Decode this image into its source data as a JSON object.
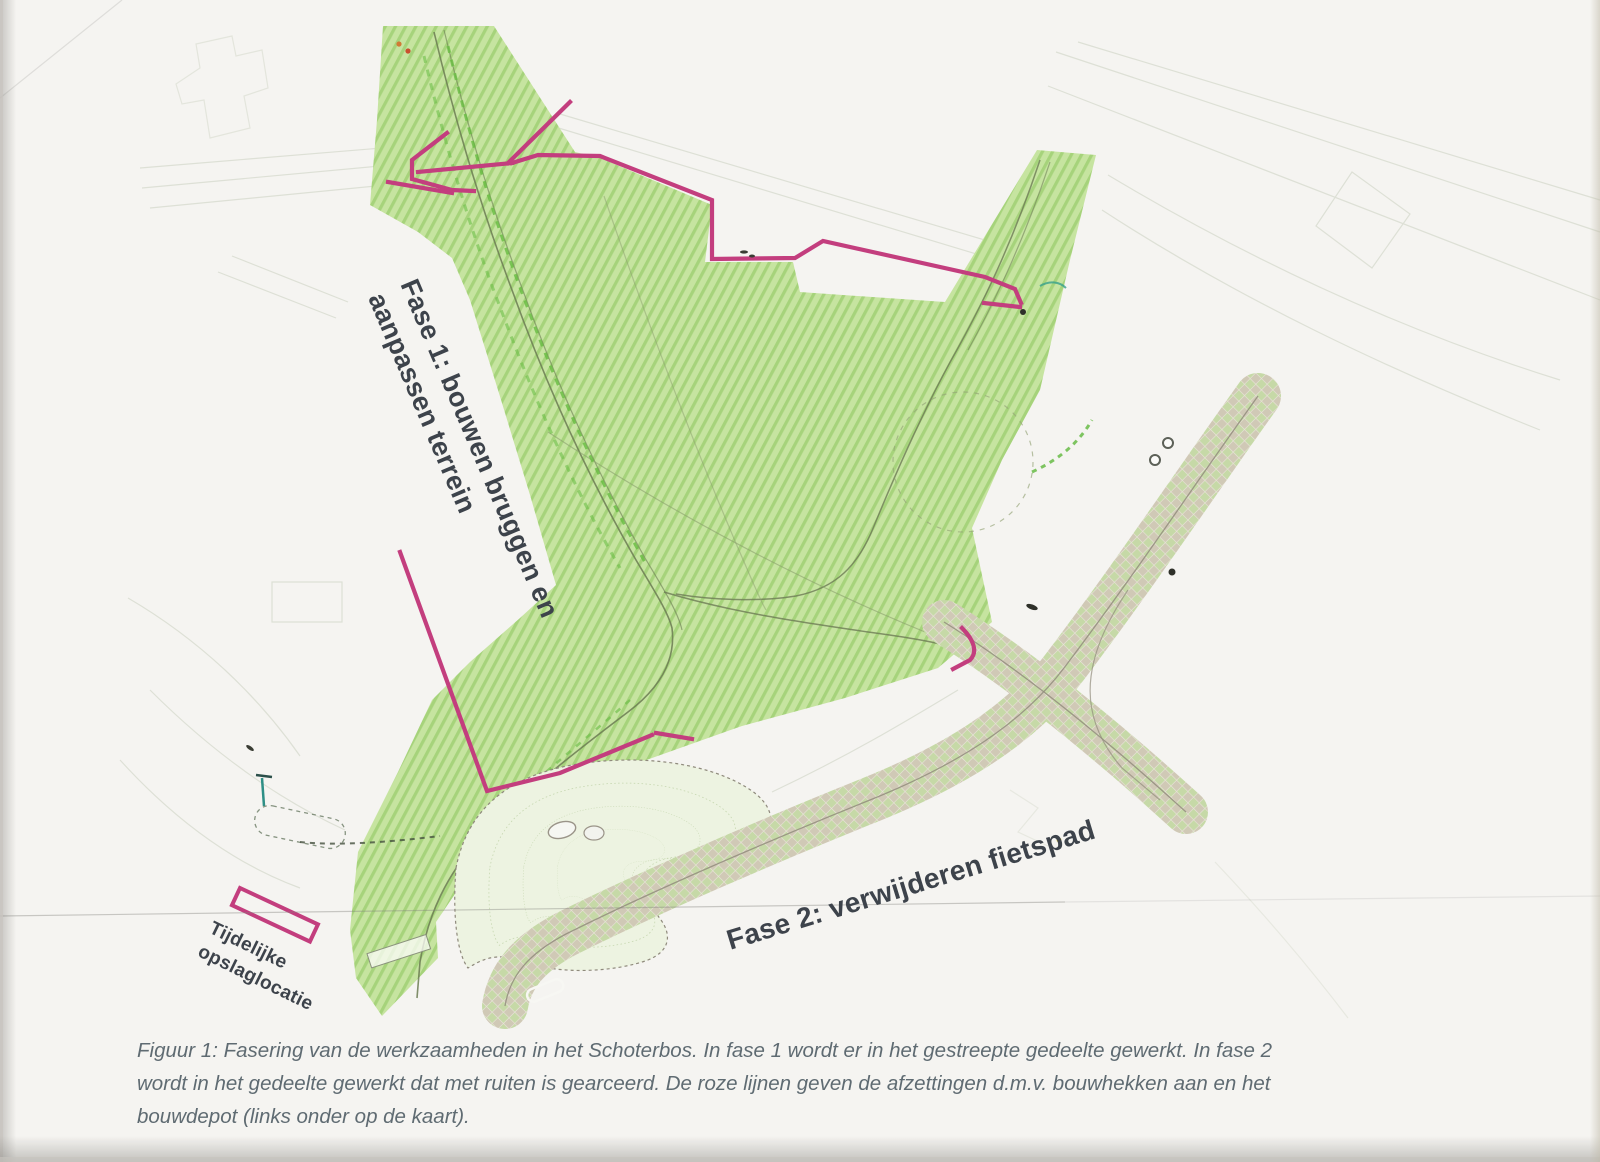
{
  "map": {
    "labels": {
      "fase1_line1": "Fase 1: bouwen bruggen en",
      "fase1_line2": "aanpassen terrein",
      "fase2": "Fase 2: verwijderen fietspad",
      "depot_line1": "Tijdelijke",
      "depot_line2": "opslaglocatie"
    }
  },
  "caption": {
    "lines": [
      "Figuur 1: Fasering van de werkzaamheden in het Schoterbos. In fase 1 wordt er in het gestreepte gedeelte gewerkt. In fase 2",
      "wordt in het gedeelte gewerkt dat met ruiten is gearceerd. De roze lijnen geven de afzettingen d.m.v. bouwhekken aan en het",
      "bouwdepot (links onder op de kaart)."
    ]
  },
  "colors": {
    "paper": "#f5f4f1",
    "fase1-green": "#b9dd92",
    "fase2-beige": "#cfc8b5",
    "fence-pink": "#c33e7e",
    "label-text": "#3d434b",
    "caption-text": "#5f6b72"
  }
}
